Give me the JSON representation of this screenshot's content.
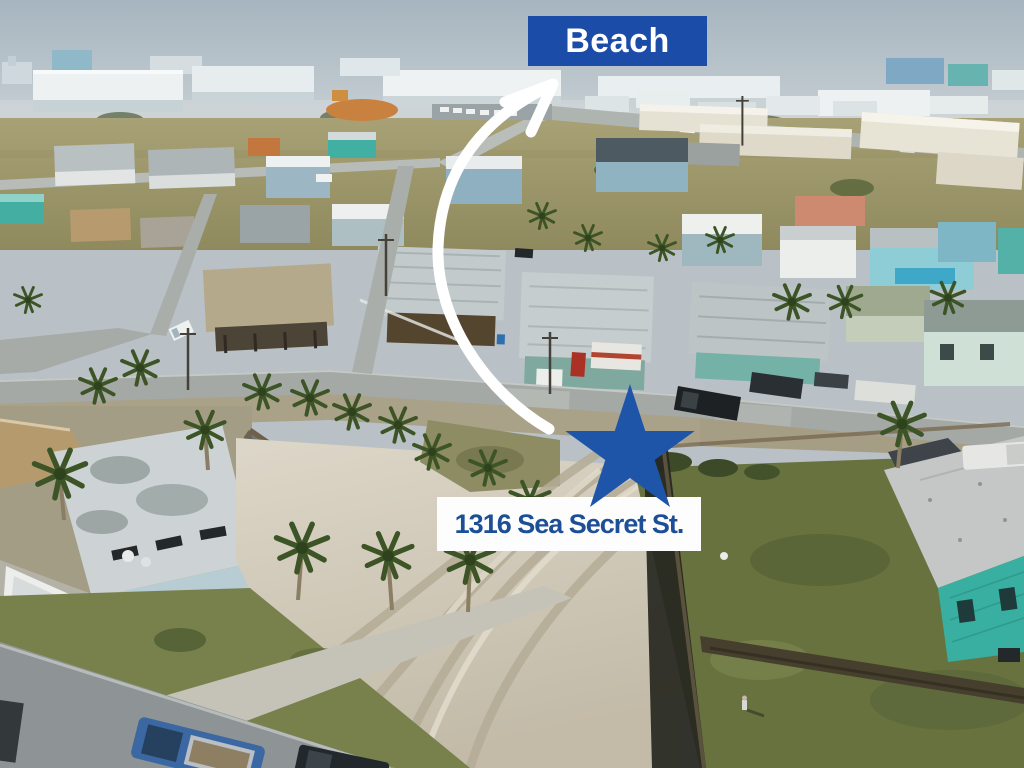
{
  "annotations": {
    "beach_label": "Beach",
    "address_label": "1316 Sea Secret St."
  },
  "colors": {
    "beach_box_blue": "#1b4ca8",
    "star_blue": "#1e55a8",
    "address_text_blue": "#1d4f96",
    "address_box_white": "#fdfdfd",
    "arrow_white": "#ffffff"
  },
  "scene": {
    "description": "Aerial drone view of a coastal neighborhood: hazy sky and condo buildings on the horizon, rows of beach houses and palm trees, a sandy vacant lot with tire tracks in the foreground, a grassy fenced lot with a teal house at right, streets with parked vehicles and a blue pickup truck at bottom left"
  }
}
